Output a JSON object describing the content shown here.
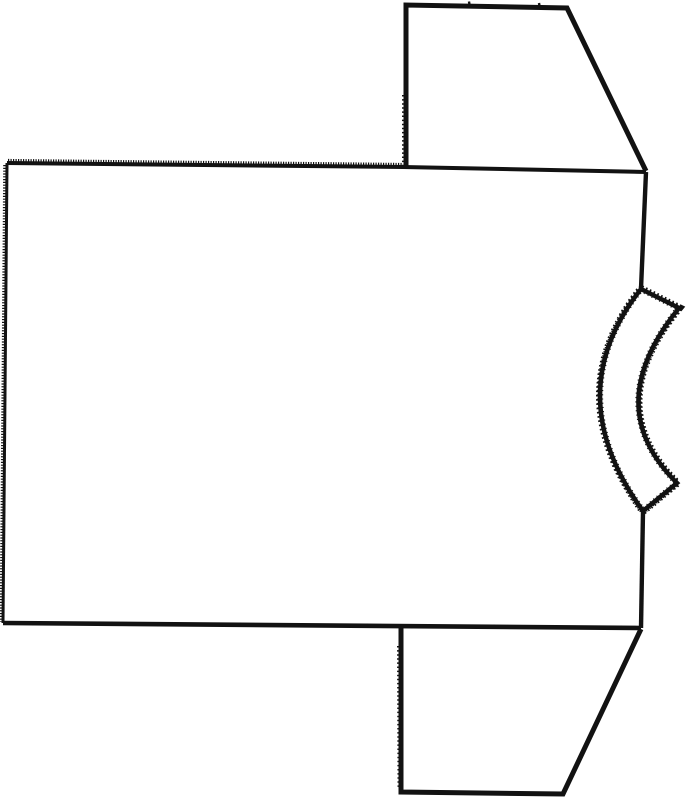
{
  "meta": {
    "title": "T-shirt sewing pattern diagram",
    "description": "Scanned black-and-white line drawing of a T-shirt pattern lying on its side: large rectangular body panel with serrated shoulder edge, two trapezoid sleeves on the right, and a curved neckband strip cut into the right edge",
    "background_color": "#ffffff",
    "ink_color": "#121212",
    "canvas": {
      "width": 687,
      "height": 800
    }
  },
  "figure": {
    "pieces": [
      {
        "name": "neckband-strip",
        "description": "curved crescent neckband piece bulging left from the right edge"
      },
      {
        "name": "body-panel",
        "description": "large rectangular torso panel"
      },
      {
        "name": "sleeve-top",
        "description": "upper trapezoid sleeve piece"
      },
      {
        "name": "sleeve-bottom",
        "description": "lower trapezoid sleeve piece"
      }
    ],
    "paths": [
      {
        "name": "neckband-fuzz-outer",
        "d": "M641,289 L679,308 Q599,406 677,483 L643,511 Q558,394 641,289 Z",
        "width": 8,
        "dash": "1.6 2.6",
        "fill": "none"
      },
      {
        "name": "neckband-panel",
        "d": "M641,289 L679,308 Q599,406 677,483 L643,511 Q558,394 641,289 Z",
        "width": 4.5,
        "dash": "",
        "fill": "#ffffff"
      },
      {
        "name": "neckband-fuzz-inner",
        "d": "M641,289 L679,308 Q599,406 677,483 L643,511 Q558,394 641,289 Z",
        "width": 6.3,
        "dash": "1.1 3.2",
        "fill": "none"
      },
      {
        "name": "body-shoulder-serration",
        "d": "M8,160.5 L403,164.5",
        "width": 3.2,
        "dash": "1.2 1.3",
        "fill": "none"
      },
      {
        "name": "body-side-serration",
        "d": "M4.5,165 L1,622",
        "width": 2.6,
        "dash": "1.2 1.6",
        "fill": "none"
      },
      {
        "name": "body-shoulder-seam",
        "d": "M7,163 L403,167 L646,172",
        "width": 4,
        "dash": "",
        "fill": "none"
      },
      {
        "name": "body-side-seam",
        "d": "M7,163 L3,623",
        "width": 3,
        "dash": "",
        "fill": "none"
      },
      {
        "name": "body-hem-edge",
        "d": "M3,623 L641,628",
        "width": 4.6,
        "dash": "",
        "fill": "none"
      },
      {
        "name": "body-right-edge-upper",
        "d": "M646,172 L641,288.5",
        "width": 4.4,
        "dash": "",
        "fill": "none"
      },
      {
        "name": "body-right-edge-lower",
        "d": "M643,511.5 L641,628",
        "width": 4.4,
        "dash": "",
        "fill": "none"
      },
      {
        "name": "sleeve-top-fold-dots",
        "d": "M403,95 L403,166",
        "width": 2,
        "dash": "1.5 2.6",
        "fill": "none"
      },
      {
        "name": "sleeve-top-outline",
        "d": "M406,167 L406,5 L567,8 L646,171",
        "width": 5,
        "dash": "",
        "fill": "none"
      },
      {
        "name": "sleeve-top-notch-1",
        "d": "M469,1.5 L470,8",
        "width": 2.4,
        "dash": "",
        "fill": "none"
      },
      {
        "name": "sleeve-top-notch-2",
        "d": "M539,3 L540,9",
        "width": 2.4,
        "dash": "",
        "fill": "none"
      },
      {
        "name": "sleeve-bottom-fold-dots",
        "d": "M398,646 L398.5,788",
        "width": 2,
        "dash": "1.5 2.6",
        "fill": "none"
      },
      {
        "name": "sleeve-bottom-outline",
        "d": "M401,627.5 L401,792 L563,794 L641,629",
        "width": 5,
        "dash": "",
        "fill": "none"
      }
    ]
  }
}
